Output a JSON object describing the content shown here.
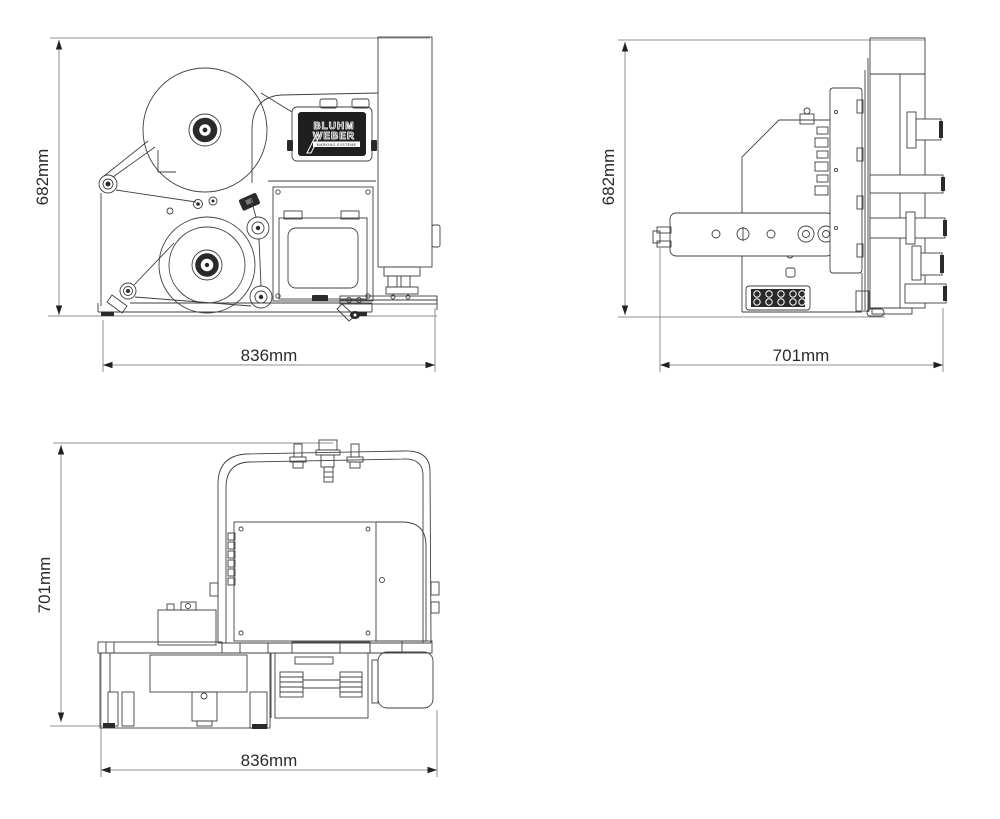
{
  "drawing": {
    "type": "technical-orthographic-views",
    "description": "Label printer-applicator dimensional drawing, three views",
    "brand": {
      "line1": "BLUHM",
      "line2": "WEBER",
      "tagline": "MARKING-SYSTEME"
    },
    "views": [
      {
        "name": "front",
        "height_label": "682mm",
        "width_label": "836mm"
      },
      {
        "name": "side",
        "height_label": "682mm",
        "width_label": "701mm"
      },
      {
        "name": "top",
        "height_label": "701mm",
        "width_label": "836mm"
      }
    ],
    "colors": {
      "background": "#ffffff",
      "machine_line": "#3f3f3f",
      "dimension_line": "#8f8f8f",
      "arrow_and_text": "#222222",
      "brand_label_bg": "#1f1f1f",
      "brand_label_text": "#ffffff"
    }
  }
}
